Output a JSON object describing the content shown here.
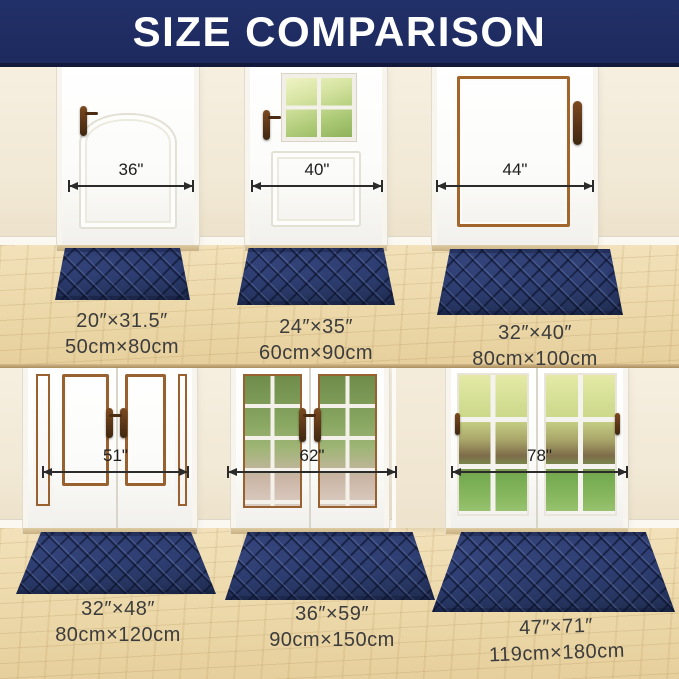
{
  "header": {
    "title": "SIZE COMPARISON"
  },
  "panels": [
    {
      "door_width": "36\"",
      "mat_inches": "20″×31.5″",
      "mat_cm": "50cm×80cm"
    },
    {
      "door_width": "40\"",
      "mat_inches": "24″×35″",
      "mat_cm": "60cm×90cm"
    },
    {
      "door_width": "44\"",
      "mat_inches": "32″×40″",
      "mat_cm": "80cm×100cm"
    },
    {
      "door_width": "51\"",
      "mat_inches": "32″×48″",
      "mat_cm": "80cm×120cm"
    },
    {
      "door_width": "62\"",
      "mat_inches": "36″×59″",
      "mat_cm": "90cm×150cm"
    },
    {
      "door_width": "78\"",
      "mat_inches": "47″×71″",
      "mat_cm": "119cm×180cm"
    }
  ],
  "colors": {
    "banner_navy": "#1d2a5e",
    "mat_navy": "#2d3d70",
    "wall_cream": "#f3ebda",
    "floor_wood": "#ecd8a9",
    "copper_trim": "#9a6130",
    "handle_brown": "#5a3517",
    "measure_line": "#2b2b2b"
  }
}
